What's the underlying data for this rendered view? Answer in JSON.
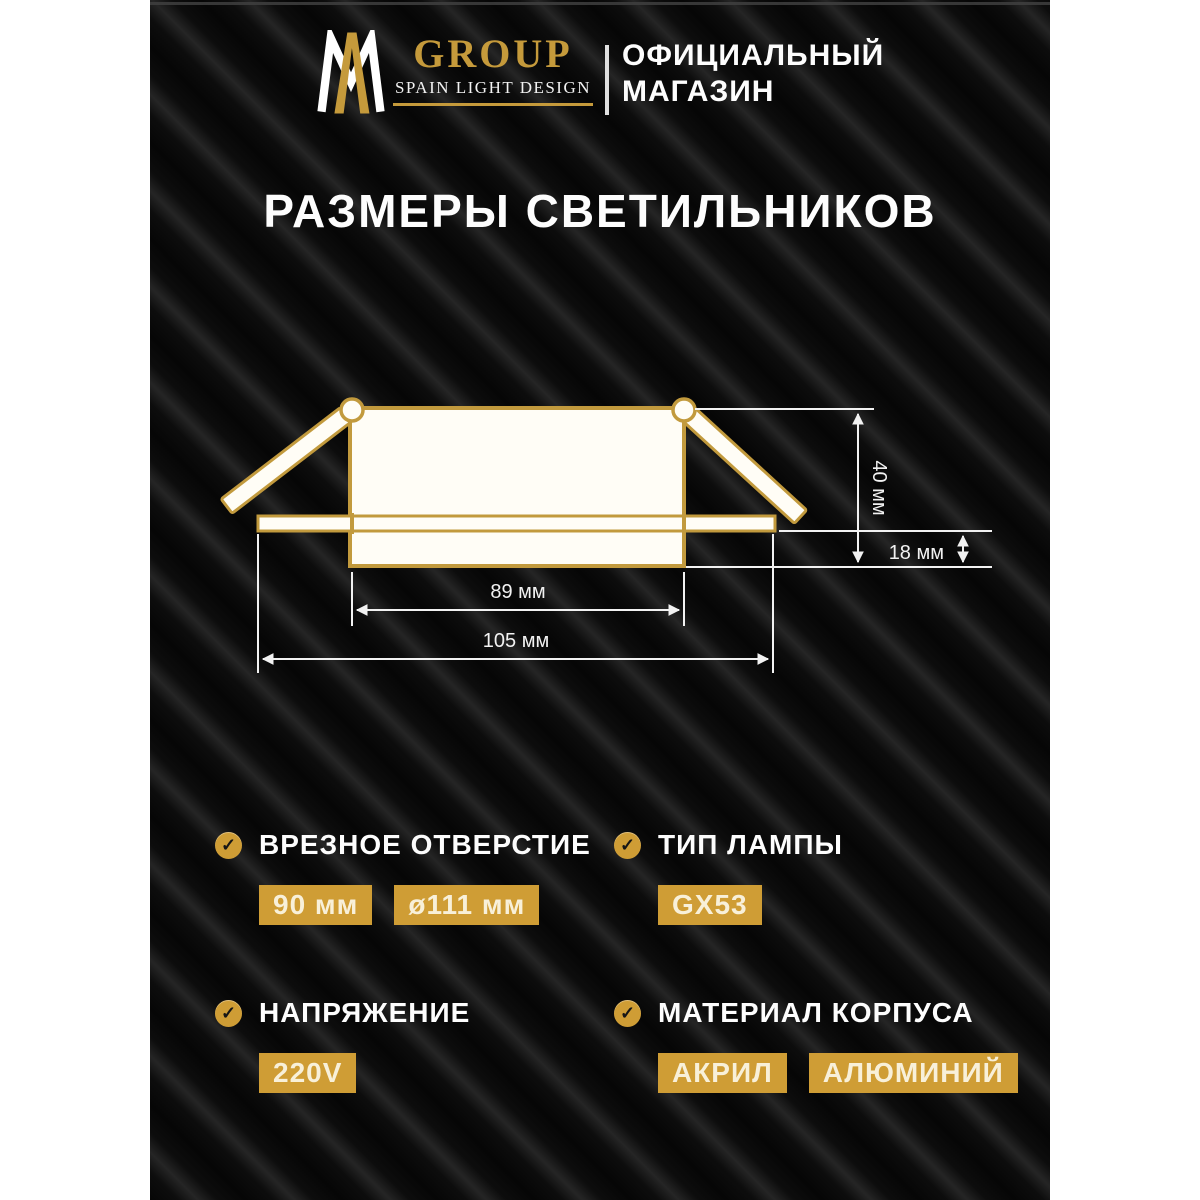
{
  "header": {
    "monogram": "AM",
    "brand_name": "GROUP",
    "brand_tagline": "SPAIN LIGHT DESIGN",
    "store_line1": "ОФИЦИАЛЬНЫЙ",
    "store_line2": "МАГАЗИН"
  },
  "title": "РАЗМЕРЫ СВЕТИЛЬНИКОВ",
  "diagram": {
    "dim_total_height": "40 мм",
    "dim_rim_height": "18 мм",
    "dim_body_width": "89 мм",
    "dim_flange_width": "105 мм"
  },
  "icons": {
    "check_glyph": "✓"
  },
  "specs": [
    {
      "label": "ВРЕЗНОЕ ОТВЕРСТИЕ",
      "values": [
        "90 мм",
        "ø111 мм"
      ]
    },
    {
      "label": "ТИП ЛАМПЫ",
      "values": [
        "GX53"
      ]
    },
    {
      "label": "НАПРЯЖЕНИЕ",
      "values": [
        "220V"
      ]
    },
    {
      "label": "МАТЕРИАЛ КОРПУСА",
      "values": [
        "АКРИЛ",
        "АЛЮМИНИЙ"
      ]
    }
  ],
  "colors": {
    "gold_accent": "#cf9d35",
    "logo_gold": "#c59a3b",
    "fixture_outline_gold": "#c29a3d",
    "background_black": "#0b0b0b",
    "text_white": "#ffffff"
  }
}
